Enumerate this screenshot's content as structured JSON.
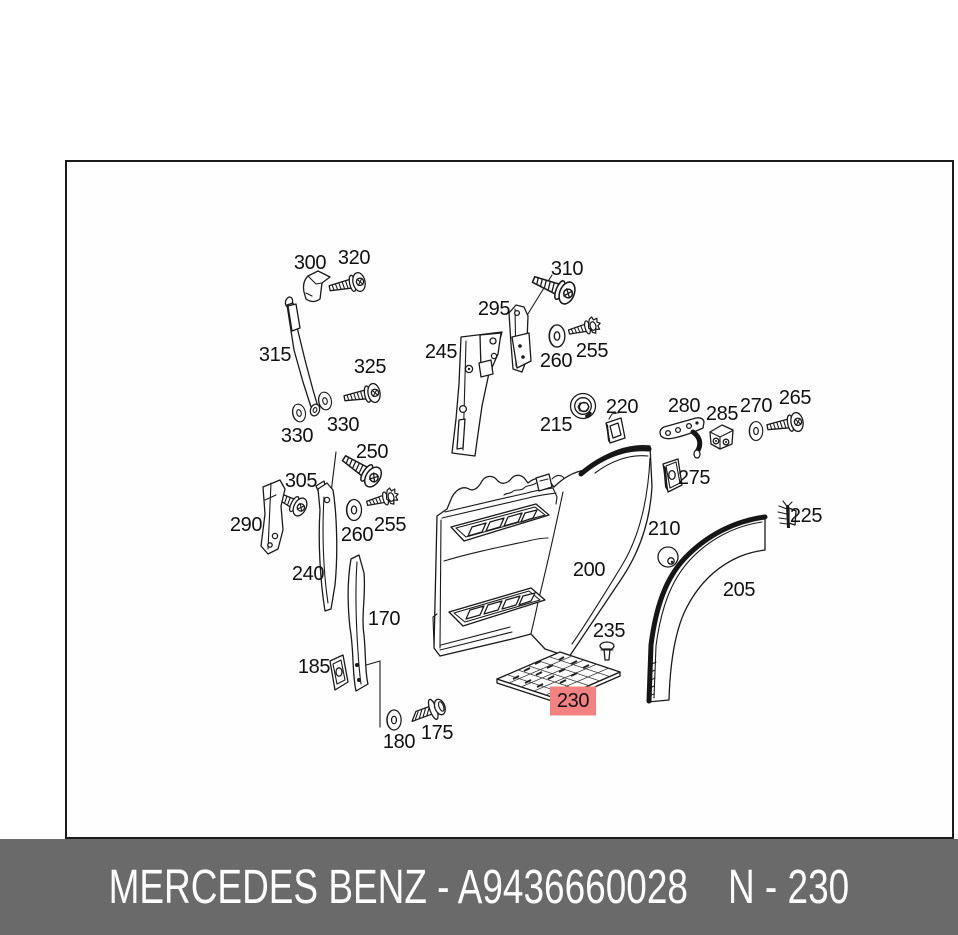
{
  "diagram": {
    "border_color": "#1b1b1b",
    "line_color": "#1a1a1a",
    "labels": [
      {
        "text": "300",
        "x": 310,
        "y": 263
      },
      {
        "text": "320",
        "x": 354,
        "y": 258
      },
      {
        "text": "310",
        "x": 567,
        "y": 269
      },
      {
        "text": "295",
        "x": 494,
        "y": 309
      },
      {
        "text": "245",
        "x": 441,
        "y": 352
      },
      {
        "text": "260",
        "x": 556,
        "y": 361
      },
      {
        "text": "255",
        "x": 592,
        "y": 351
      },
      {
        "text": "315",
        "x": 275,
        "y": 355
      },
      {
        "text": "325",
        "x": 370,
        "y": 367
      },
      {
        "text": "330",
        "x": 297,
        "y": 436
      },
      {
        "text": "330",
        "x": 343,
        "y": 425
      },
      {
        "text": "250",
        "x": 372,
        "y": 452
      },
      {
        "text": "305",
        "x": 301,
        "y": 481
      },
      {
        "text": "290",
        "x": 246,
        "y": 525
      },
      {
        "text": "260",
        "x": 357,
        "y": 535
      },
      {
        "text": "255",
        "x": 390,
        "y": 525
      },
      {
        "text": "240",
        "x": 308,
        "y": 574
      },
      {
        "text": "215",
        "x": 556,
        "y": 425
      },
      {
        "text": "220",
        "x": 622,
        "y": 407
      },
      {
        "text": "280",
        "x": 684,
        "y": 406
      },
      {
        "text": "285",
        "x": 722,
        "y": 414
      },
      {
        "text": "270",
        "x": 756,
        "y": 406
      },
      {
        "text": "265",
        "x": 795,
        "y": 398
      },
      {
        "text": "275",
        "x": 694,
        "y": 478
      },
      {
        "text": "225",
        "x": 806,
        "y": 516
      },
      {
        "text": "210",
        "x": 664,
        "y": 529
      },
      {
        "text": "200",
        "x": 589,
        "y": 570
      },
      {
        "text": "205",
        "x": 739,
        "y": 590
      },
      {
        "text": "170",
        "x": 384,
        "y": 619
      },
      {
        "text": "185",
        "x": 314,
        "y": 667
      },
      {
        "text": "235",
        "x": 609,
        "y": 631
      },
      {
        "text": "230",
        "x": 573,
        "y": 701,
        "highlighted": true
      },
      {
        "text": "180",
        "x": 399,
        "y": 742
      },
      {
        "text": "175",
        "x": 437,
        "y": 733
      }
    ]
  },
  "highlight": {
    "bg": "#f48181",
    "text_color": "#8e2727"
  },
  "footer": {
    "left_text": "MERCEDES BENZ - A9436660028",
    "right_text": "N - 230",
    "bg": "#6a6a6a",
    "text_color": "#fdfdfd"
  }
}
